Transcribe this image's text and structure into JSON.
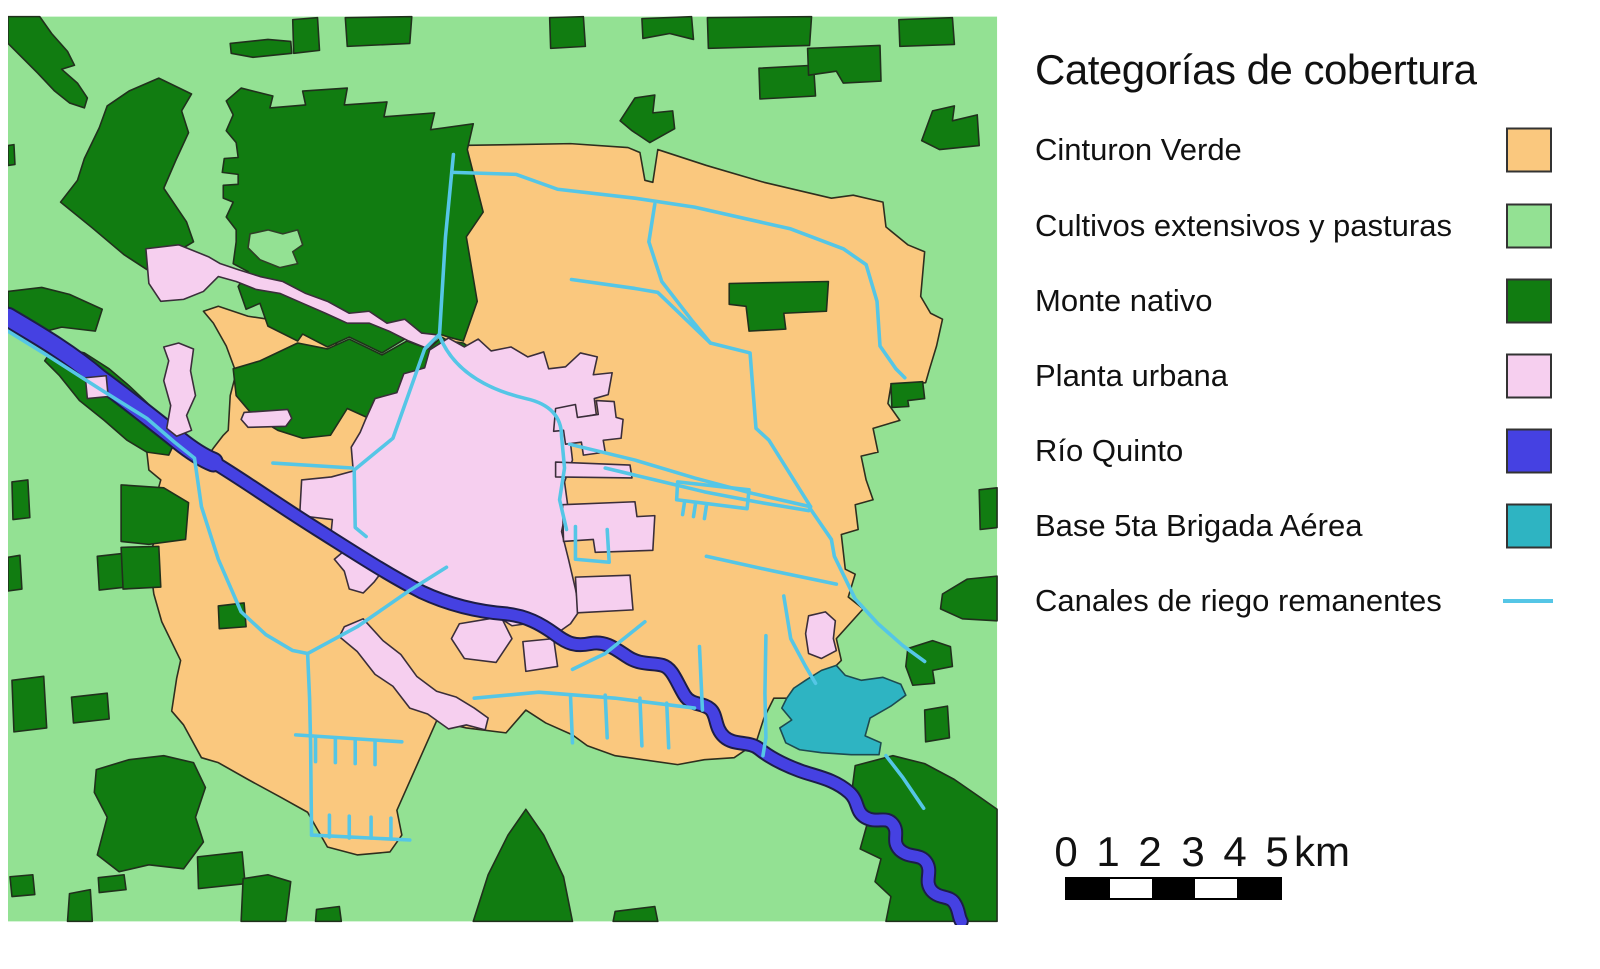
{
  "legend": {
    "title": "Categorías de cobertura",
    "items": [
      {
        "label": "Cinturon Verde",
        "color": "#FAC87E",
        "type": "fill"
      },
      {
        "label": "Cultivos extensivos y pasturas",
        "color": "#93E193",
        "type": "fill"
      },
      {
        "label": "Monte nativo",
        "color": "#117C11",
        "type": "fill"
      },
      {
        "label": "Planta urbana",
        "color": "#F6CFEF",
        "type": "fill"
      },
      {
        "label": "Río Quinto",
        "color": "#4541E2",
        "type": "fill"
      },
      {
        "label": "Base 5ta Brigada Aérea",
        "color": "#2EB4C2",
        "type": "fill"
      },
      {
        "label": "Canales de riego remanentes",
        "color": "#55C6E6",
        "type": "line"
      }
    ]
  },
  "scalebar": {
    "ticks": [
      "0",
      "1",
      "2",
      "3",
      "4",
      "5"
    ],
    "unit": "km"
  }
}
